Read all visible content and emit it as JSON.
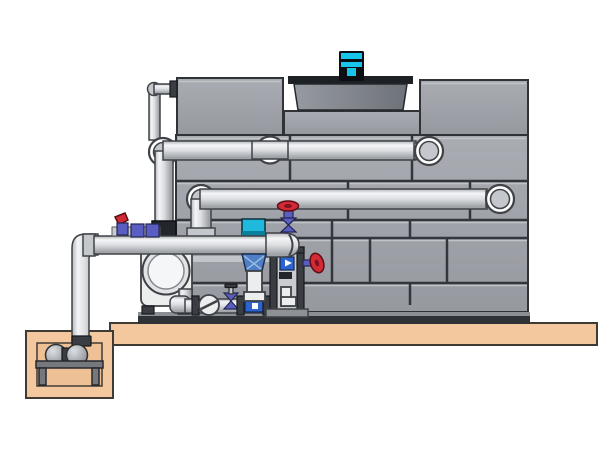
{
  "scene": {
    "description_parts": [
      "cooling-tower-casing",
      "tower-panel-grid",
      "fan-cowl",
      "fan-motor",
      "upper-distribution-pipe",
      "middle-return-pipe",
      "lower-suction-pipe",
      "vent-pipe",
      "riser-drop-pipe",
      "concrete-slab",
      "sump-pit",
      "sump-pump",
      "circulation-pump",
      "vertical-inline-pump",
      "red-gate-valve",
      "side-handwheel-valve",
      "ball-valve-cluster",
      "check-valve",
      "small-gate-valve",
      "filter-column",
      "bottom-manifold"
    ]
  },
  "palette": {
    "background": "#ffffff",
    "panel": "#a9acb2",
    "panel_dark": "#96999f",
    "panel_light": "#c6c9cd",
    "seam": "#33363c",
    "outline": "#2f3237",
    "cowl_light": "#969aa1",
    "cowl_dark": "#6e7279",
    "cowl_rim": "#1d2024",
    "motor_cyan": "#19c5ea",
    "motor_dark": "#0b0e13",
    "pipe_edge": "#b2b5b9",
    "pipe_hi": "#f4f5f7",
    "pipe_mid": "#dcdee1",
    "pipe_lo": "#a0a3a8",
    "pipe_outline": "#3f4247",
    "white": "#ffffff",
    "gray_mid": "#c4c7cb",
    "slab": "#f4c89e",
    "slab_outline": "#403a35",
    "pit_inner": "#eec096",
    "dark_metal": "#3a3d42",
    "base_dark": "#2f3237",
    "base_light": "#8b8e93",
    "pump_body": "#eceded",
    "steel_blue": "#4d7fc6",
    "cyan": "#1fb9dd",
    "cyan_dark": "#0a7f9b",
    "indigo": "#5a5ec2",
    "red": "#d42a35",
    "device_blue": "#2c63cc",
    "platform": "#75787d",
    "sphere_hi": "#dde0e3",
    "sphere_lo": "#7e8187"
  }
}
